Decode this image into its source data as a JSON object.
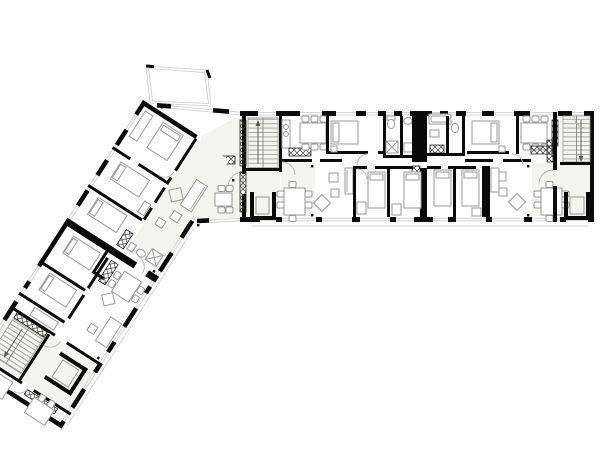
{
  "meta": {
    "description": "Black-and-white architectural floor plan: L-shaped multi-family residential building with a straight east wing and a south-west wing angled at about 123 degrees, joined by a corner apartment with balcony"
  },
  "canvas": {
    "width": 600,
    "height": 472,
    "background": "#ffffff"
  },
  "colors": {
    "bg": "#ffffff",
    "wall": "#0a0a0a",
    "furniture": "#9a9a9a",
    "thin": "#c9c9c9",
    "floor": "#f3f3f1",
    "door": "#b4b4b4",
    "tread": "#8f8f8f"
  },
  "plan": {
    "wings": [
      {
        "id": "east-wing",
        "angle_deg": 0
      },
      {
        "id": "southwest-wing",
        "angle_deg": 122.7
      }
    ],
    "circulation": {
      "stair_runs": 3,
      "elevators": 3
    },
    "balconies": 1,
    "apartments_visible": 4,
    "room_elements": [
      "bedrooms with beds and wardrobes",
      "living areas with sofas, coffee tables and rugs",
      "dining tables with chairs",
      "kitchen counters with hob strips",
      "bathrooms with tub, shower, wc and basin",
      "service shafts shown cross-hatched"
    ],
    "symbols": [
      "door swing arcs",
      "double-line window glazing",
      "stair treads with direction arrows",
      "column dots",
      "terrace edge lines"
    ]
  }
}
